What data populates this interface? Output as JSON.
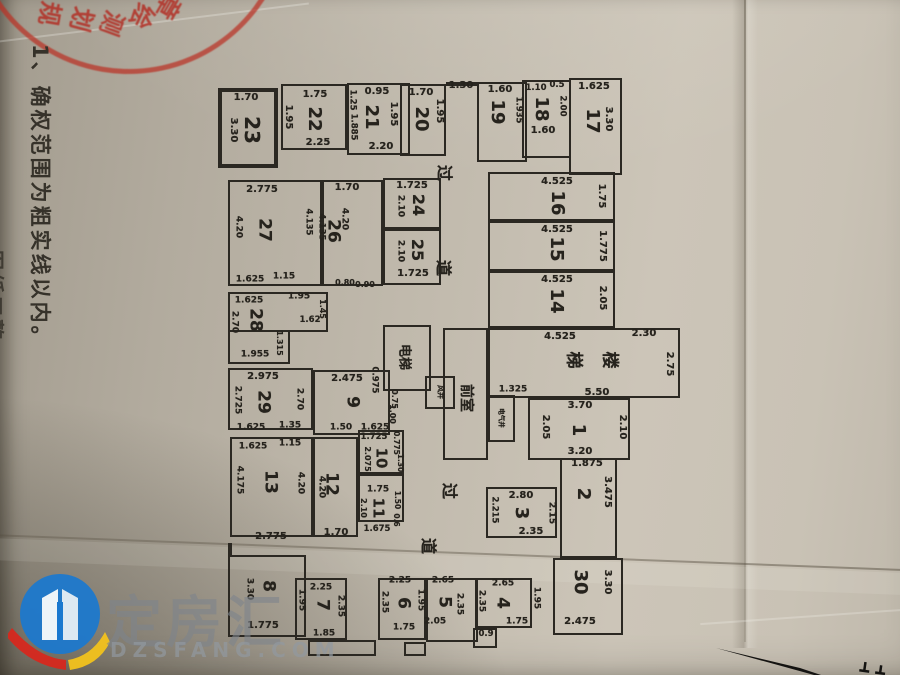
{
  "notes": {
    "line1": "1、确权范围为粗实线以内。",
    "line2": "图纸工整"
  },
  "stamp": {
    "chars": [
      {
        "t": "规",
        "x": 52,
        "y": 14,
        "r": 100
      },
      {
        "t": "划",
        "x": 84,
        "y": 20,
        "r": 105
      },
      {
        "t": "测",
        "x": 114,
        "y": 24,
        "r": 110
      },
      {
        "t": "绘",
        "x": 144,
        "y": 17,
        "r": 115
      },
      {
        "t": "章",
        "x": 170,
        "y": 8,
        "r": 120
      }
    ]
  },
  "watermark": {
    "brand": "定房汇",
    "domain": "DZSFANG.COM"
  },
  "colors": {
    "line": "#2b2822",
    "ink": "#26231d",
    "stamp_red": "#b22a20",
    "brand_blue": "#1a78cf",
    "brand_red": "#d6281e",
    "brand_yellow": "#f2c21c",
    "paper": "#c0b9ac"
  },
  "plan": {
    "boxes": [
      [
        218,
        88,
        60,
        80,
        1
      ],
      [
        281,
        84,
        66,
        66,
        0
      ],
      [
        347,
        83,
        63,
        72,
        0
      ],
      [
        400,
        84,
        46,
        72,
        0
      ],
      [
        477,
        82,
        50,
        80,
        0
      ],
      [
        522,
        80,
        49,
        78,
        0
      ],
      [
        569,
        78,
        53,
        97,
        0
      ],
      [
        488,
        172,
        127,
        49,
        0
      ],
      [
        488,
        221,
        127,
        50,
        0
      ],
      [
        488,
        271,
        127,
        57,
        0
      ],
      [
        488,
        328,
        192,
        70,
        0
      ],
      [
        383,
        325,
        48,
        66,
        0
      ],
      [
        443,
        328,
        45,
        132,
        0
      ],
      [
        425,
        376,
        30,
        33,
        0
      ],
      [
        488,
        395,
        27,
        47,
        0
      ],
      [
        528,
        398,
        102,
        62,
        0
      ],
      [
        560,
        458,
        57,
        100,
        0
      ],
      [
        486,
        487,
        71,
        51,
        0
      ],
      [
        553,
        558,
        70,
        77,
        0
      ],
      [
        383,
        178,
        58,
        51,
        0
      ],
      [
        383,
        229,
        58,
        56,
        0
      ],
      [
        322,
        180,
        61,
        106,
        0
      ],
      [
        228,
        180,
        94,
        106,
        0
      ],
      [
        228,
        292,
        100,
        40,
        0
      ],
      [
        228,
        330,
        62,
        34,
        0
      ],
      [
        228,
        368,
        85,
        62,
        0
      ],
      [
        313,
        370,
        77,
        65,
        0
      ],
      [
        230,
        437,
        83,
        100,
        0
      ],
      [
        313,
        437,
        45,
        100,
        0
      ],
      [
        358,
        430,
        46,
        44,
        0
      ],
      [
        358,
        474,
        46,
        48,
        0
      ],
      [
        228,
        555,
        78,
        82,
        0
      ],
      [
        295,
        578,
        52,
        62,
        0
      ],
      [
        308,
        640,
        68,
        16,
        0
      ],
      [
        378,
        578,
        48,
        62,
        0
      ],
      [
        426,
        578,
        52,
        64,
        0
      ],
      [
        404,
        642,
        22,
        14,
        0
      ],
      [
        475,
        578,
        57,
        50,
        0
      ],
      [
        473,
        628,
        24,
        20,
        0
      ],
      [
        446,
        82,
        31,
        2,
        0
      ],
      [
        228,
        543,
        2,
        12,
        0
      ]
    ],
    "labels": [
      [
        "1.70",
        246,
        98,
        0,
        "d",
        10
      ],
      [
        "23",
        252,
        130,
        1,
        "n",
        20
      ],
      [
        "3.30",
        233,
        130,
        1,
        "d",
        10
      ],
      [
        "1.75",
        315,
        95,
        0,
        "d",
        10
      ],
      [
        "1.95",
        288,
        117,
        1,
        "d",
        10
      ],
      [
        "22",
        314,
        119,
        1,
        "n",
        18
      ],
      [
        "2.25",
        318,
        143,
        0,
        "d",
        10
      ],
      [
        "0.95",
        377,
        92,
        0,
        "d",
        10
      ],
      [
        "1.25",
        352,
        100,
        1,
        "d",
        8.5
      ],
      [
        "1.885",
        353,
        127,
        1,
        "d",
        8.5
      ],
      [
        "21",
        371,
        117,
        1,
        "n",
        18
      ],
      [
        "1.95",
        393,
        114,
        1,
        "d",
        10
      ],
      [
        "2.20",
        381,
        147,
        0,
        "d",
        10
      ],
      [
        "1.70",
        421,
        93,
        0,
        "d",
        10
      ],
      [
        "20",
        421,
        119,
        1,
        "n",
        18
      ],
      [
        "1.95",
        439,
        111,
        1,
        "d",
        10
      ],
      [
        "1.30",
        461,
        86,
        0,
        "d",
        10
      ],
      [
        "1.60",
        500,
        90,
        0,
        "d",
        10
      ],
      [
        "19",
        497,
        112,
        1,
        "n",
        18
      ],
      [
        "1.935",
        518,
        110,
        1,
        "d",
        8.5
      ],
      [
        "1.10",
        536,
        88,
        0,
        "d",
        8.5
      ],
      [
        "0.5",
        557,
        85,
        0,
        "d",
        8.5
      ],
      [
        "18",
        541,
        109,
        1,
        "n",
        18
      ],
      [
        "2.00",
        562,
        106,
        1,
        "d",
        8.5
      ],
      [
        "1.60",
        543,
        131,
        0,
        "d",
        10
      ],
      [
        "1.625",
        594,
        87,
        0,
        "d",
        10
      ],
      [
        "17",
        592,
        121,
        1,
        "n",
        18
      ],
      [
        "3.30",
        608,
        119,
        1,
        "d",
        10
      ],
      [
        "4.525",
        557,
        182,
        0,
        "d",
        10
      ],
      [
        "16",
        557,
        203,
        1,
        "n",
        18
      ],
      [
        "1.75",
        601,
        196,
        1,
        "d",
        10
      ],
      [
        "4.525",
        557,
        230,
        0,
        "d",
        10
      ],
      [
        "15",
        556,
        249,
        1,
        "n",
        18
      ],
      [
        "1.775",
        602,
        246,
        1,
        "d",
        10
      ],
      [
        "4.525",
        557,
        280,
        0,
        "d",
        10
      ],
      [
        "14",
        556,
        301,
        1,
        "n",
        18
      ],
      [
        "2.05",
        602,
        298,
        1,
        "d",
        10
      ],
      [
        "4.525",
        560,
        337,
        0,
        "d",
        10
      ],
      [
        "2.30",
        644,
        334,
        0,
        "d",
        10
      ],
      [
        "梯",
        573,
        360,
        1,
        "z",
        17
      ],
      [
        "楼",
        609,
        360,
        1,
        "z",
        17
      ],
      [
        "2.75",
        669,
        364,
        1,
        "d",
        10
      ],
      [
        "5.50",
        597,
        393,
        0,
        "d",
        10
      ],
      [
        "电梯",
        404,
        357,
        1,
        "z",
        13
      ],
      [
        "前室",
        466,
        398,
        1,
        "z",
        14
      ],
      [
        "风井",
        440,
        392,
        1,
        "z",
        7
      ],
      [
        "电气井",
        501,
        418,
        1,
        "z",
        6.5
      ],
      [
        "1.325",
        513,
        390,
        0,
        "d",
        9
      ],
      [
        "0.975",
        374,
        380,
        1,
        "d",
        8.5
      ],
      [
        "0.75",
        394,
        399,
        1,
        "d",
        8
      ],
      [
        "1.00",
        392,
        414,
        1,
        "d",
        8
      ],
      [
        "3.70",
        580,
        406,
        0,
        "d",
        10
      ],
      [
        "1",
        578,
        430,
        1,
        "n",
        18
      ],
      [
        "2.05",
        545,
        427,
        1,
        "d",
        10
      ],
      [
        "2.10",
        622,
        427,
        1,
        "d",
        10
      ],
      [
        "3.20",
        580,
        452,
        0,
        "d",
        10
      ],
      [
        "1.875",
        587,
        464,
        0,
        "d",
        10
      ],
      [
        "2",
        583,
        494,
        1,
        "n",
        18
      ],
      [
        "3.475",
        607,
        492,
        1,
        "d",
        10
      ],
      [
        "2.80",
        521,
        496,
        0,
        "d",
        10
      ],
      [
        "2.215",
        494,
        510,
        1,
        "d",
        8.5
      ],
      [
        "3",
        521,
        513,
        1,
        "n",
        18
      ],
      [
        "2.15",
        551,
        513,
        1,
        "d",
        9
      ],
      [
        "2.35",
        531,
        532,
        0,
        "d",
        10
      ],
      [
        "30",
        580,
        582,
        1,
        "n",
        18
      ],
      [
        "3.30",
        607,
        582,
        1,
        "d",
        10
      ],
      [
        "2.475",
        580,
        622,
        0,
        "d",
        10
      ],
      [
        "过",
        444,
        173,
        1,
        "z",
        16
      ],
      [
        "道",
        443,
        268,
        1,
        "z",
        16
      ],
      [
        "过",
        449,
        491,
        1,
        "z",
        16
      ],
      [
        "道",
        428,
        546,
        1,
        "z",
        16
      ],
      [
        "1.725",
        412,
        186,
        0,
        "d",
        10
      ],
      [
        "2.10",
        400,
        206,
        1,
        "d",
        9
      ],
      [
        "24",
        418,
        205,
        1,
        "n",
        16
      ],
      [
        "2.10",
        400,
        251,
        1,
        "d",
        9
      ],
      [
        "25",
        417,
        250,
        1,
        "n",
        16
      ],
      [
        "1.725",
        413,
        274,
        0,
        "d",
        10
      ],
      [
        "1.70",
        347,
        188,
        0,
        "d",
        10
      ],
      [
        "4.20",
        344,
        219,
        1,
        "d",
        9
      ],
      [
        "26",
        333,
        231,
        1,
        "n",
        17
      ],
      [
        "4.135",
        321,
        227,
        1,
        "d",
        8.5
      ],
      [
        "0.80",
        345,
        283,
        0,
        "d",
        8
      ],
      [
        "0.90",
        365,
        285,
        0,
        "d",
        8
      ],
      [
        "2.775",
        262,
        190,
        0,
        "d",
        10
      ],
      [
        "4.20",
        238,
        227,
        1,
        "d",
        9
      ],
      [
        "27",
        264,
        230,
        1,
        "n",
        17
      ],
      [
        "4.135",
        308,
        222,
        1,
        "d",
        8.5
      ],
      [
        "1.625",
        250,
        280,
        0,
        "d",
        9
      ],
      [
        "1.15",
        284,
        277,
        0,
        "d",
        9
      ],
      [
        "1.625",
        249,
        301,
        0,
        "d",
        9
      ],
      [
        "1.95",
        299,
        297,
        0,
        "d",
        9
      ],
      [
        "28",
        255,
        320,
        1,
        "n",
        17
      ],
      [
        "2.70",
        234,
        322,
        1,
        "d",
        9
      ],
      [
        "1.45",
        322,
        309,
        1,
        "d",
        8
      ],
      [
        "1.62",
        310,
        320,
        0,
        "d",
        8.5
      ],
      [
        "1.315",
        279,
        343,
        1,
        "d",
        8
      ],
      [
        "1.955",
        255,
        355,
        0,
        "d",
        9
      ],
      [
        "2.975",
        263,
        377,
        0,
        "d",
        10
      ],
      [
        "2.725",
        237,
        400,
        1,
        "d",
        9
      ],
      [
        "29",
        263,
        402,
        1,
        "n",
        17
      ],
      [
        "2.70",
        299,
        399,
        1,
        "d",
        9
      ],
      [
        "1.625",
        251,
        428,
        0,
        "d",
        9
      ],
      [
        "1.35",
        290,
        426,
        0,
        "d",
        9
      ],
      [
        "2.475",
        347,
        379,
        0,
        "d",
        10
      ],
      [
        "9",
        352,
        402,
        1,
        "n",
        17
      ],
      [
        "1.50",
        341,
        428,
        0,
        "d",
        9
      ],
      [
        "1.625",
        375,
        428,
        0,
        "d",
        9
      ],
      [
        "1.625",
        253,
        447,
        0,
        "d",
        9
      ],
      [
        "1.15",
        290,
        444,
        0,
        "d",
        9
      ],
      [
        "4.175",
        239,
        480,
        1,
        "d",
        9
      ],
      [
        "13",
        270,
        482,
        1,
        "n",
        17
      ],
      [
        "4.20",
        300,
        483,
        1,
        "d",
        9
      ],
      [
        "2.775",
        271,
        537,
        0,
        "d",
        10
      ],
      [
        "12",
        331,
        484,
        1,
        "n",
        17
      ],
      [
        "4.20",
        321,
        487,
        1,
        "d",
        9
      ],
      [
        "1.70",
        336,
        533,
        0,
        "d",
        10
      ],
      [
        "1.725",
        374,
        437,
        0,
        "d",
        8.5
      ],
      [
        "10",
        381,
        458,
        1,
        "n",
        15
      ],
      [
        "2.075",
        367,
        459,
        1,
        "d",
        8
      ],
      [
        "0.775",
        396,
        443,
        1,
        "d",
        7.5
      ],
      [
        "1.30",
        400,
        463,
        1,
        "d",
        7.5
      ],
      [
        "1.75",
        378,
        490,
        0,
        "d",
        9
      ],
      [
        "11",
        378,
        508,
        1,
        "n",
        15
      ],
      [
        "2.10",
        363,
        508,
        1,
        "d",
        8
      ],
      [
        "1.50",
        397,
        500,
        1,
        "d",
        7.5
      ],
      [
        "0.6",
        396,
        520,
        1,
        "d",
        7.5
      ],
      [
        "1.675",
        377,
        529,
        0,
        "d",
        8.5
      ],
      [
        "8",
        268,
        586,
        1,
        "n",
        17
      ],
      [
        "3.30",
        249,
        589,
        1,
        "d",
        9
      ],
      [
        "1.775",
        263,
        626,
        0,
        "d",
        10
      ],
      [
        "2.25",
        321,
        588,
        0,
        "d",
        9
      ],
      [
        "1.95",
        301,
        600,
        1,
        "d",
        9
      ],
      [
        "7",
        322,
        605,
        1,
        "n",
        17
      ],
      [
        "2.35",
        340,
        606,
        1,
        "d",
        9
      ],
      [
        "1.85",
        324,
        634,
        0,
        "d",
        9
      ],
      [
        "2.25",
        400,
        581,
        0,
        "d",
        9
      ],
      [
        "2.35",
        384,
        602,
        1,
        "d",
        9
      ],
      [
        "6",
        403,
        603,
        1,
        "n",
        17
      ],
      [
        "1.95",
        420,
        600,
        1,
        "d",
        9
      ],
      [
        "1.75",
        404,
        628,
        0,
        "d",
        9
      ],
      [
        "2.65",
        443,
        581,
        0,
        "d",
        9
      ],
      [
        "5",
        444,
        602,
        1,
        "n",
        17
      ],
      [
        "2.35",
        459,
        604,
        1,
        "d",
        9
      ],
      [
        "2.05",
        435,
        622,
        0,
        "d",
        9
      ],
      [
        "2.65",
        503,
        584,
        0,
        "d",
        9
      ],
      [
        "2.35",
        481,
        601,
        1,
        "d",
        9
      ],
      [
        "4",
        502,
        603,
        1,
        "n",
        17
      ],
      [
        "1.95",
        536,
        598,
        1,
        "d",
        9
      ],
      [
        "1.75",
        517,
        622,
        0,
        "d",
        9
      ],
      [
        "0.9",
        486,
        634,
        0,
        "d",
        8.5
      ]
    ]
  }
}
